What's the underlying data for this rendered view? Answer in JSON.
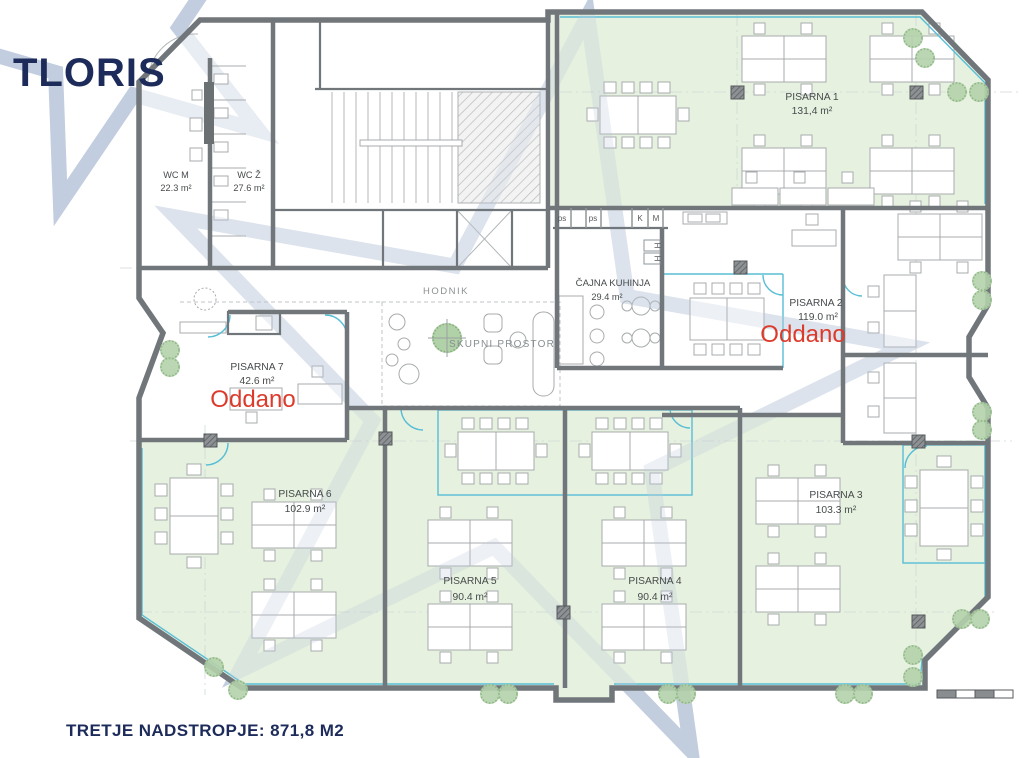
{
  "title": "TLORIS",
  "footer": "TRETJE NADSTROPJE: 871,8 M2",
  "colors": {
    "navy": "#1c2b5a",
    "status_red": "#dc3b2c",
    "room_green": "#e3efdb",
    "glass_cyan": "#57bed6",
    "wall_gray": "#70767a",
    "watermark_blue": "#c2cddf"
  },
  "rooms": {
    "wc_m": {
      "name": "WC M",
      "area": "22.3 m²"
    },
    "wc_z": {
      "name": "WC Ž",
      "area": "27.6 m²"
    },
    "p1": {
      "name": "PISARNA 1",
      "area": "131,4 m²"
    },
    "kuhinja": {
      "name": "ČAJNA KUHINJA",
      "area": "29.4 m²"
    },
    "p2": {
      "name": "PISARNA 2",
      "area": "119.0 m²",
      "status": "Oddano"
    },
    "p7": {
      "name": "PISARNA 7",
      "area": "42.6 m²",
      "status": "Oddano"
    },
    "hodnik": {
      "name": "HODNIK"
    },
    "skupni": {
      "name": "SKUPNI PROSTOR"
    },
    "p6": {
      "name": "PISARNA 6",
      "area": "102.9 m²"
    },
    "p5": {
      "name": "PISARNA 5",
      "area": "90.4 m²"
    },
    "p4": {
      "name": "PISARNA 4",
      "area": "90.4 m²"
    },
    "p3": {
      "name": "PISARNA 3",
      "area": "103.3 m²"
    }
  },
  "utility_labels": {
    "ps": "ps",
    "k": "K",
    "m": "M",
    "h": "H"
  }
}
